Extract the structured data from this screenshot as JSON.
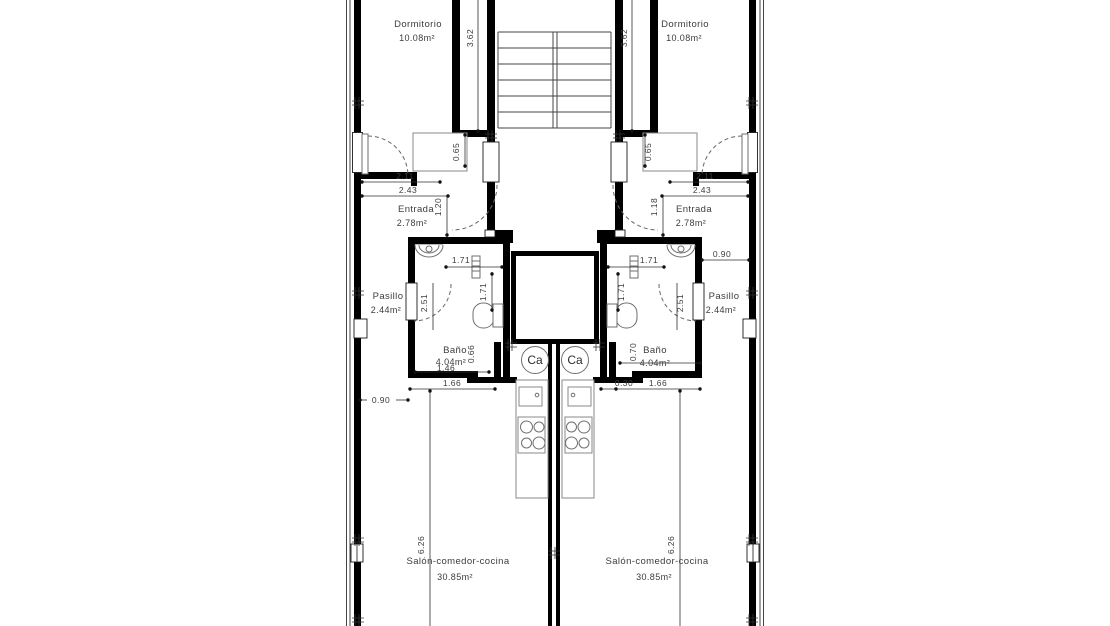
{
  "plan": {
    "boiler_label": "Ca",
    "left": {
      "dormitorio": {
        "name": "Dormitorio",
        "area": "10.08m²"
      },
      "entrada": {
        "name": "Entrada",
        "area": "2.78m²"
      },
      "pasillo": {
        "name": "Pasillo",
        "area": "2.44m²"
      },
      "bano": {
        "name": "Baño",
        "area": "4.04m²"
      },
      "salon": {
        "name": "Salón-comedor-cocina",
        "area": "30.85m²"
      },
      "dims": {
        "stair_side": "3.62",
        "recess": "0.65",
        "entry_w1": "2.11",
        "entry_w2": "2.43",
        "entry_depth": "1.20",
        "bath_width": "1.71",
        "bath_side": "1.71",
        "hall_length": "2.51",
        "niche": "0.66",
        "bath_inner": "1.46",
        "kitchen_front": "1.66",
        "wall_offset": "0.90",
        "salon_length": "6.26"
      }
    },
    "right": {
      "dormitorio": {
        "name": "Dormitorio",
        "area": "10.08m²"
      },
      "entrada": {
        "name": "Entrada",
        "area": "2.78m²"
      },
      "pasillo": {
        "name": "Pasillo",
        "area": "2.44m²"
      },
      "bano": {
        "name": "Baño",
        "area": "4.04m²"
      },
      "salon": {
        "name": "Salón-comedor-cocina",
        "area": "30.85m²"
      },
      "dims": {
        "stair_side": "3.62",
        "recess": "0.65",
        "entry_w1": "2.11",
        "entry_w2": "2.43",
        "entry_depth": "1.18",
        "bath_width": "1.71",
        "bath_side": "1.71",
        "hall_length": "2.51",
        "niche": "0.70",
        "strip": "0.30",
        "kitchen_front": "1.66",
        "hall_width": "0.90",
        "salon_length": "6.26"
      }
    }
  }
}
